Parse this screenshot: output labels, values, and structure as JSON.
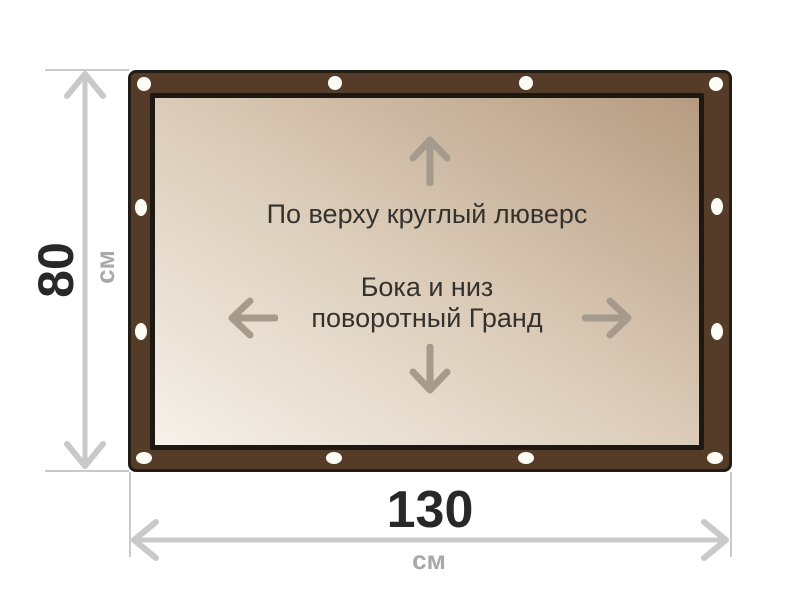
{
  "diagram": {
    "type": "banner-size-diagram",
    "banner": {
      "annotation_top": "По верху круглый люверс",
      "annotation_middle_line1": "Бока и низ",
      "annotation_middle_line2": "поворотный Гранд",
      "grommet_count": 12
    },
    "dimensions": {
      "height": {
        "value": "80",
        "unit": "см"
      },
      "width": {
        "value": "130",
        "unit": "см"
      }
    },
    "icons": {
      "arrow_up": "↑",
      "arrow_down": "↓",
      "arrow_left": "←",
      "arrow_right": "→",
      "grommet": "⬭"
    },
    "colors": {
      "frame_brown": "#553c28",
      "frame_outline": "#221c16",
      "canvas_border": "#1e1812",
      "canvas_gradient_light": "#f6f1eb",
      "canvas_gradient_dark": "#b69b81",
      "grommet": "#fdfcf5",
      "canvas_text": "#35322e",
      "canvas_arrow": "#a59a8b",
      "dimension_line": "#c9c9c9",
      "dimension_value_text": "#282828",
      "dimension_unit_text": "#a8a8a8"
    }
  }
}
